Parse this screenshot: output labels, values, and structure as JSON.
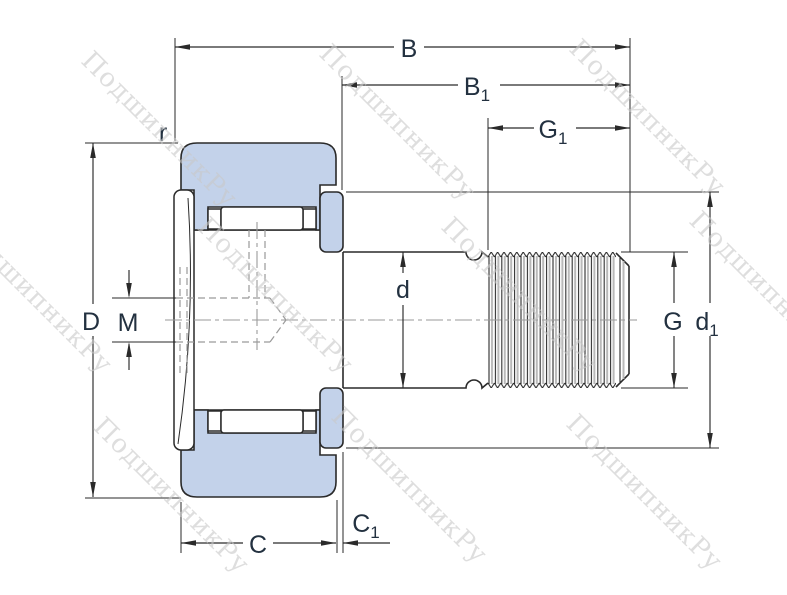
{
  "title": "Cam follower stud-type track roller cross-section drawing",
  "labels": {
    "B": {
      "base": "B"
    },
    "B1": {
      "base": "B",
      "sub": "1"
    },
    "G1": {
      "base": "G",
      "sub": "1"
    },
    "r": {
      "base": "r"
    },
    "D": {
      "base": "D"
    },
    "M": {
      "base": "M"
    },
    "d": {
      "base": "d"
    },
    "G": {
      "base": "G"
    },
    "d1": {
      "base": "d",
      "sub": "1"
    },
    "C": {
      "base": "C"
    },
    "C1": {
      "base": "C",
      "sub": "1"
    }
  },
  "watermark": {
    "text": "ПодшипникРу"
  },
  "colors": {
    "part_fill": "#c3d2ea",
    "line": "#2a2a2a",
    "label": "#233140",
    "hidden": "#9a9a9a",
    "thread_shadow": "#b9b9b9",
    "watermark": "#c9c9c9",
    "background": "#ffffff"
  }
}
